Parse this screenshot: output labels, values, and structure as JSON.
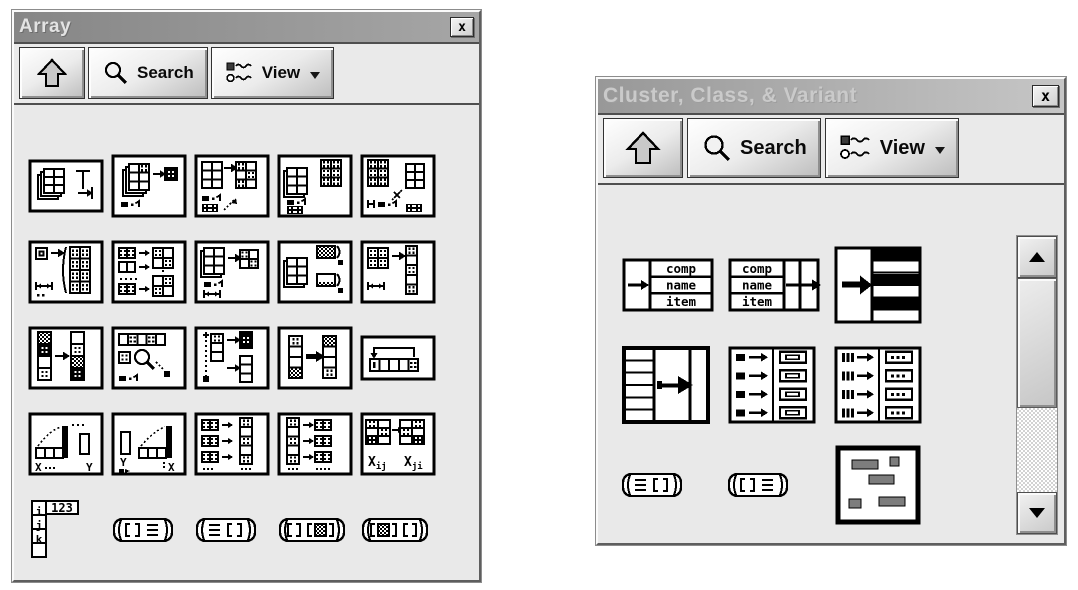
{
  "theme": {
    "desktop_bg": "#ffffff",
    "titlebar_active_a": "#868686",
    "titlebar_active_b": "#a6a6a6",
    "titlebar_inactive_a": "#989898",
    "titlebar_inactive_b": "#c6c6c6",
    "title_text_active": "#e3e3e3",
    "title_text_inactive": "#cacaca",
    "panel": "#e9e9e9",
    "icon_ink": "#000000",
    "constant_gray": "#7d7d7d"
  },
  "windows": [
    {
      "title": "Array",
      "state": "active",
      "close_button": "x",
      "toolbar": {
        "up_button": {
          "icon": "up-arrow-icon"
        },
        "search_button": {
          "icon": "magnifier-icon",
          "label": "Search"
        },
        "view_button": {
          "icon": "palette-view-icon",
          "label": "View"
        }
      },
      "palette_items": [
        {
          "name": "array-size"
        },
        {
          "name": "index-array"
        },
        {
          "name": "replace-array-subset"
        },
        {
          "name": "insert-into-array"
        },
        {
          "name": "delete-from-array"
        },
        {
          "name": "initialize-array"
        },
        {
          "name": "build-array"
        },
        {
          "name": "array-subset"
        },
        {
          "name": "array-max-and-min"
        },
        {
          "name": "reshape-array"
        },
        {
          "name": "sort-1d-array"
        },
        {
          "name": "search-1d-array"
        },
        {
          "name": "split-1d-array"
        },
        {
          "name": "reverse-1d-array"
        },
        {
          "name": "rotate-1d-array"
        },
        {
          "name": "interpolate-1d-array",
          "texts": {
            "x": "X",
            "y": "Y"
          }
        },
        {
          "name": "threshold-1d-array",
          "texts": {
            "y": "Y",
            "x": "X"
          }
        },
        {
          "name": "interleave-1d-arrays"
        },
        {
          "name": "decimate-1d-array"
        },
        {
          "name": "transpose-2d-array",
          "texts": {
            "left": "Xij",
            "right": "Xji"
          }
        },
        {
          "name": "array-constant",
          "texts": {
            "rows": [
              "i",
              "j",
              "k"
            ],
            "value": "123"
          }
        },
        {
          "name": "array-to-cluster"
        },
        {
          "name": "cluster-to-array"
        },
        {
          "name": "array-to-matrix"
        },
        {
          "name": "matrix-to-array"
        }
      ]
    },
    {
      "title": "Cluster, Class, & Variant",
      "state": "inactive",
      "close_button": "x",
      "toolbar": {
        "up_button": {
          "icon": "up-arrow-icon"
        },
        "search_button": {
          "icon": "magnifier-icon",
          "label": "Search"
        },
        "view_button": {
          "icon": "palette-view-icon",
          "label": "View"
        }
      },
      "palette_items": [
        {
          "name": "bundle-by-name",
          "texts": {
            "rows": [
              "comp",
              "name",
              "item"
            ]
          }
        },
        {
          "name": "unbundle-by-name",
          "texts": {
            "rows": [
              "comp",
              "name",
              "item"
            ]
          }
        },
        {
          "name": "bundle"
        },
        {
          "name": "unbundle"
        },
        {
          "name": "build-cluster-array"
        },
        {
          "name": "index-and-bundle-cluster-array"
        },
        {
          "name": "cluster-to-array"
        },
        {
          "name": "array-to-cluster"
        },
        {
          "name": "cluster-constant"
        }
      ],
      "scrollbar": {
        "up_icon": "scroll-up-icon",
        "down_icon": "scroll-down-icon"
      }
    }
  ]
}
